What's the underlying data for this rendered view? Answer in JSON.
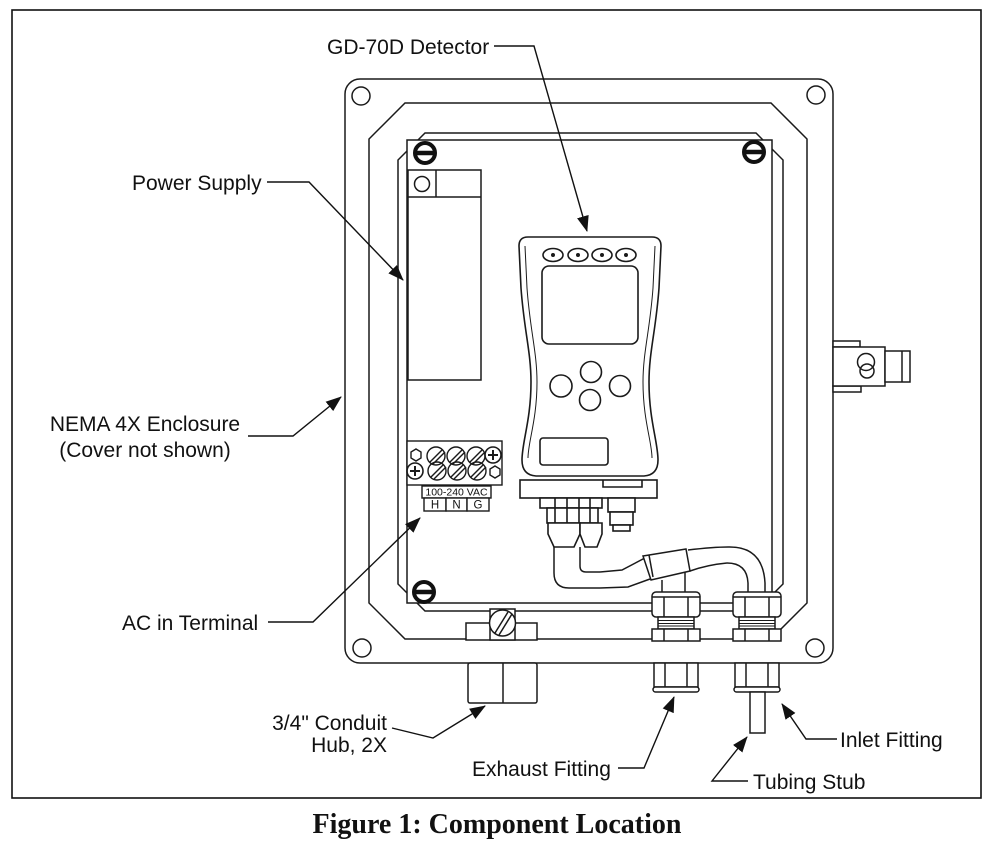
{
  "figure": {
    "caption": "Figure 1: Component Location"
  },
  "labels": {
    "detector": "GD-70D Detector",
    "power_supply": "Power Supply",
    "enclosure_line1": "NEMA 4X Enclosure",
    "enclosure_line2": "(Cover not shown)",
    "ac_terminal": "AC in Terminal",
    "conduit_line1": "3/4\" Conduit",
    "conduit_line2": "Hub, 2X",
    "exhaust": "Exhaust Fitting",
    "inlet": "Inlet Fitting",
    "tubing": "Tubing Stub"
  },
  "terminal_block": {
    "voltage": "100-240 VAC",
    "pins": [
      "H",
      "N",
      "G"
    ]
  },
  "colors": {
    "line": "#1a1a1a",
    "background": "#ffffff"
  }
}
